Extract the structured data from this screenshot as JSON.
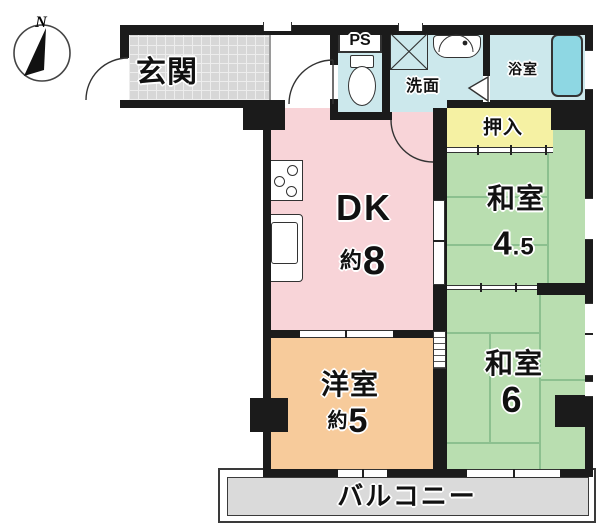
{
  "floorplan": {
    "compass": {
      "label": "N"
    },
    "rooms": {
      "entrance": {
        "label": "玄関"
      },
      "ps": {
        "label": "PS"
      },
      "washroom": {
        "label": "洗面"
      },
      "bathroom": {
        "label": "浴室"
      },
      "closet": {
        "label": "押入"
      },
      "dk": {
        "name": "DK",
        "approx": "約",
        "size": "8"
      },
      "japanese_room_45": {
        "name": "和室",
        "size_int": "4",
        "size_frac": ".5"
      },
      "japanese_room_6": {
        "name": "和室",
        "size": "6"
      },
      "western_room": {
        "name": "洋室",
        "approx": "約",
        "size": "5"
      },
      "balcony": {
        "label": "バルコニー"
      }
    },
    "colors": {
      "wall": "#1b1b1b",
      "dk": "#f8d4d8",
      "washitsu": "#b9deb0",
      "tatami": "#8cc08f",
      "youshitsu": "#f7cb9b",
      "oshiire": "#f5f1a3",
      "water": "#cce8ec",
      "bathtub": "#8ed7e3",
      "tile": "#d7d7d7",
      "balcony": "#dadada"
    }
  }
}
